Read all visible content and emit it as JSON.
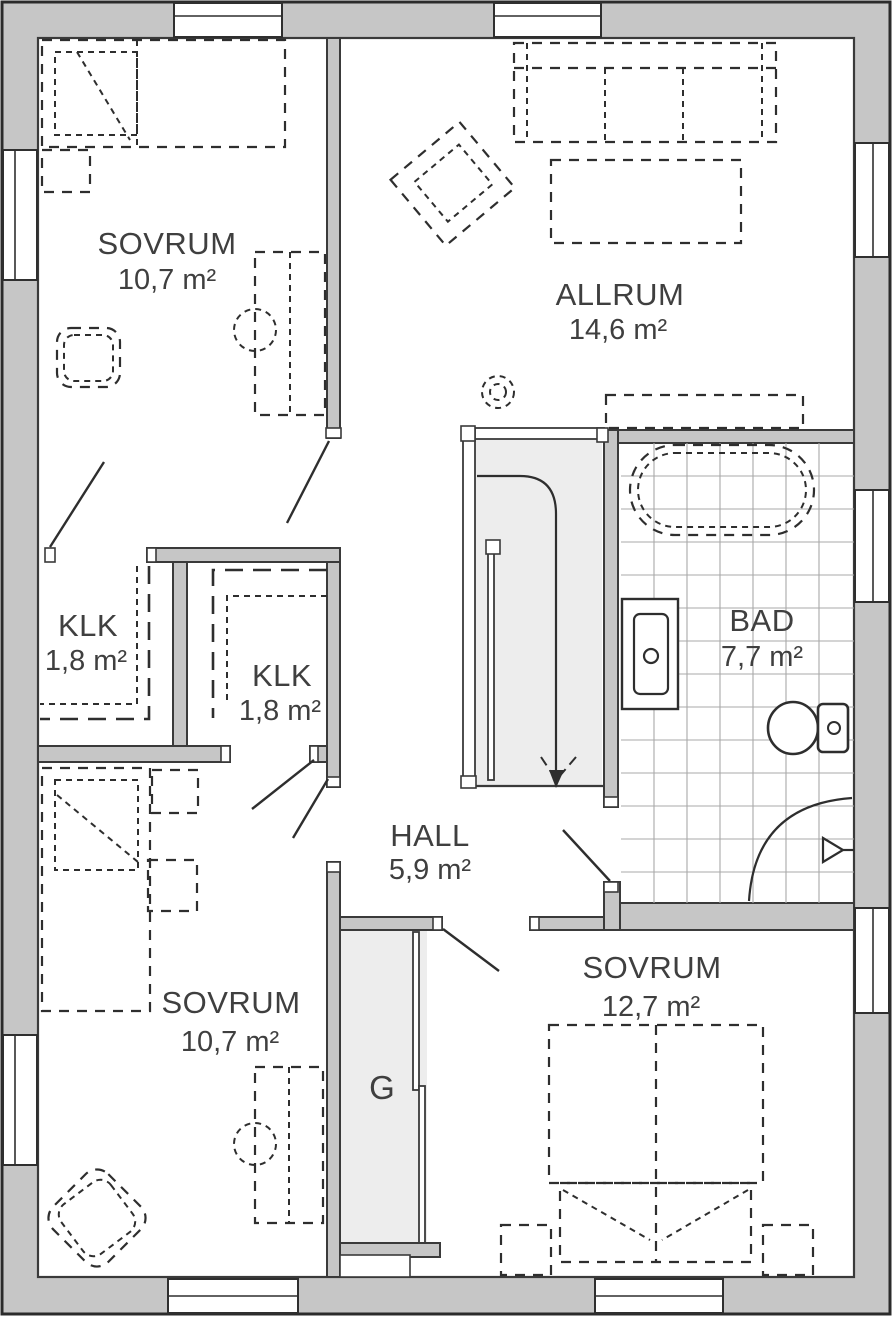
{
  "plan": {
    "type": "floor-plan",
    "language": "Swedish",
    "rooms": [
      {
        "id": "sovrum-top-left",
        "name": "SOVRUM",
        "area": "10,7 m²"
      },
      {
        "id": "allrum",
        "name": "ALLRUM",
        "area": "14,6 m²"
      },
      {
        "id": "klk-left",
        "name": "KLK",
        "area": "1,8 m²"
      },
      {
        "id": "klk-middle",
        "name": "KLK",
        "area": "1,8 m²"
      },
      {
        "id": "bad",
        "name": "BAD",
        "area": "7,7 m²"
      },
      {
        "id": "hall",
        "name": "HALL",
        "area": "5,9 m²"
      },
      {
        "id": "sovrum-bottom-left",
        "name": "SOVRUM",
        "area": "10,7 m²"
      },
      {
        "id": "sovrum-bottom-right",
        "name": "SOVRUM",
        "area": "12,7 m²"
      },
      {
        "id": "garderob",
        "name": "G"
      }
    ],
    "colors": {
      "wall_fill": "#c6c6c6",
      "outline": "#3a3a3a",
      "floor": "#ffffff",
      "stair_fill": "#ededed",
      "text": "#3f3f3f",
      "tile_line": "#a8a8a8"
    }
  }
}
